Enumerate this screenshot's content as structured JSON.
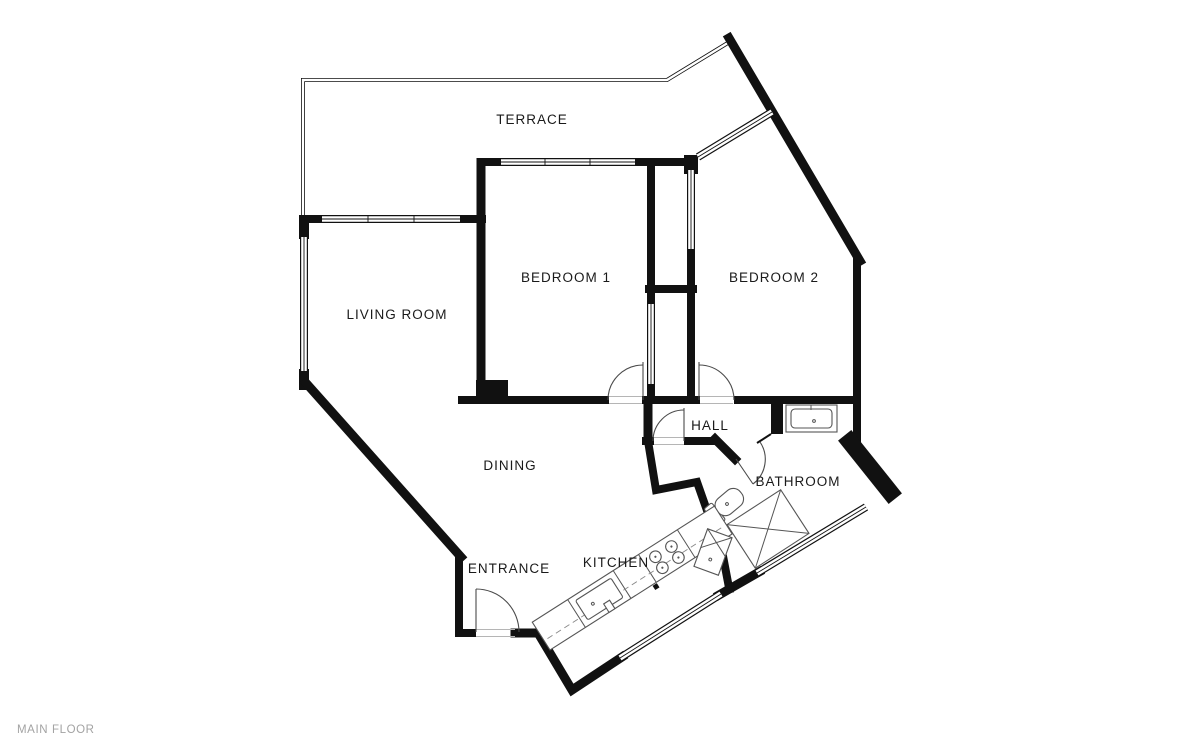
{
  "plan": {
    "floor_label": "MAIN FLOOR",
    "colors": {
      "background": "#ffffff",
      "wall": "#111111",
      "label": "#1a1a1a",
      "fixture": "#555555",
      "floor_label": "#a3a3a3"
    },
    "rooms": [
      {
        "label": "TERRACE"
      },
      {
        "label": "BEDROOM 1"
      },
      {
        "label": "BEDROOM 2"
      },
      {
        "label": "LIVING ROOM"
      },
      {
        "label": "HALL"
      },
      {
        "label": "BATHROOM"
      },
      {
        "label": "DINING"
      },
      {
        "label": "ENTRANCE"
      },
      {
        "label": "KITCHEN"
      }
    ],
    "fixtures": [
      "bathroom-sink",
      "toilet",
      "shower",
      "kitchen-counter",
      "kitchen-sink",
      "stove",
      "appliance"
    ]
  }
}
